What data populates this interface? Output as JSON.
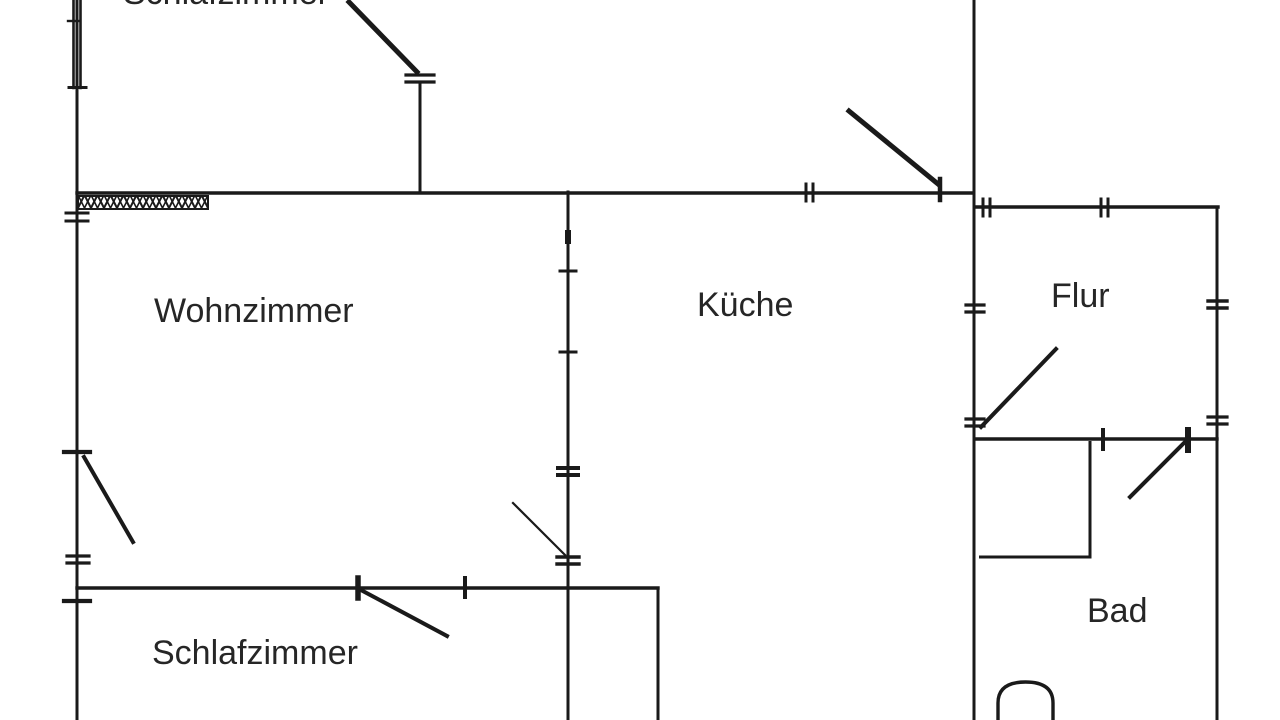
{
  "document": {
    "type": "apartment floor plan (scanned)",
    "background_color": "#ffffff",
    "line_color": "#1a1a1a",
    "text_color": "#262626"
  },
  "rooms": [
    {
      "id": "schlafzimmer-top",
      "label": "Schlafzimmer"
    },
    {
      "id": "wohnzimmer",
      "label": "Wohnzimmer"
    },
    {
      "id": "kueche",
      "label": "Küche"
    },
    {
      "id": "flur",
      "label": "Flur"
    },
    {
      "id": "bad",
      "label": "Bad"
    },
    {
      "id": "schlafzimmer-bottom",
      "label": "Schlafzimmer"
    }
  ]
}
